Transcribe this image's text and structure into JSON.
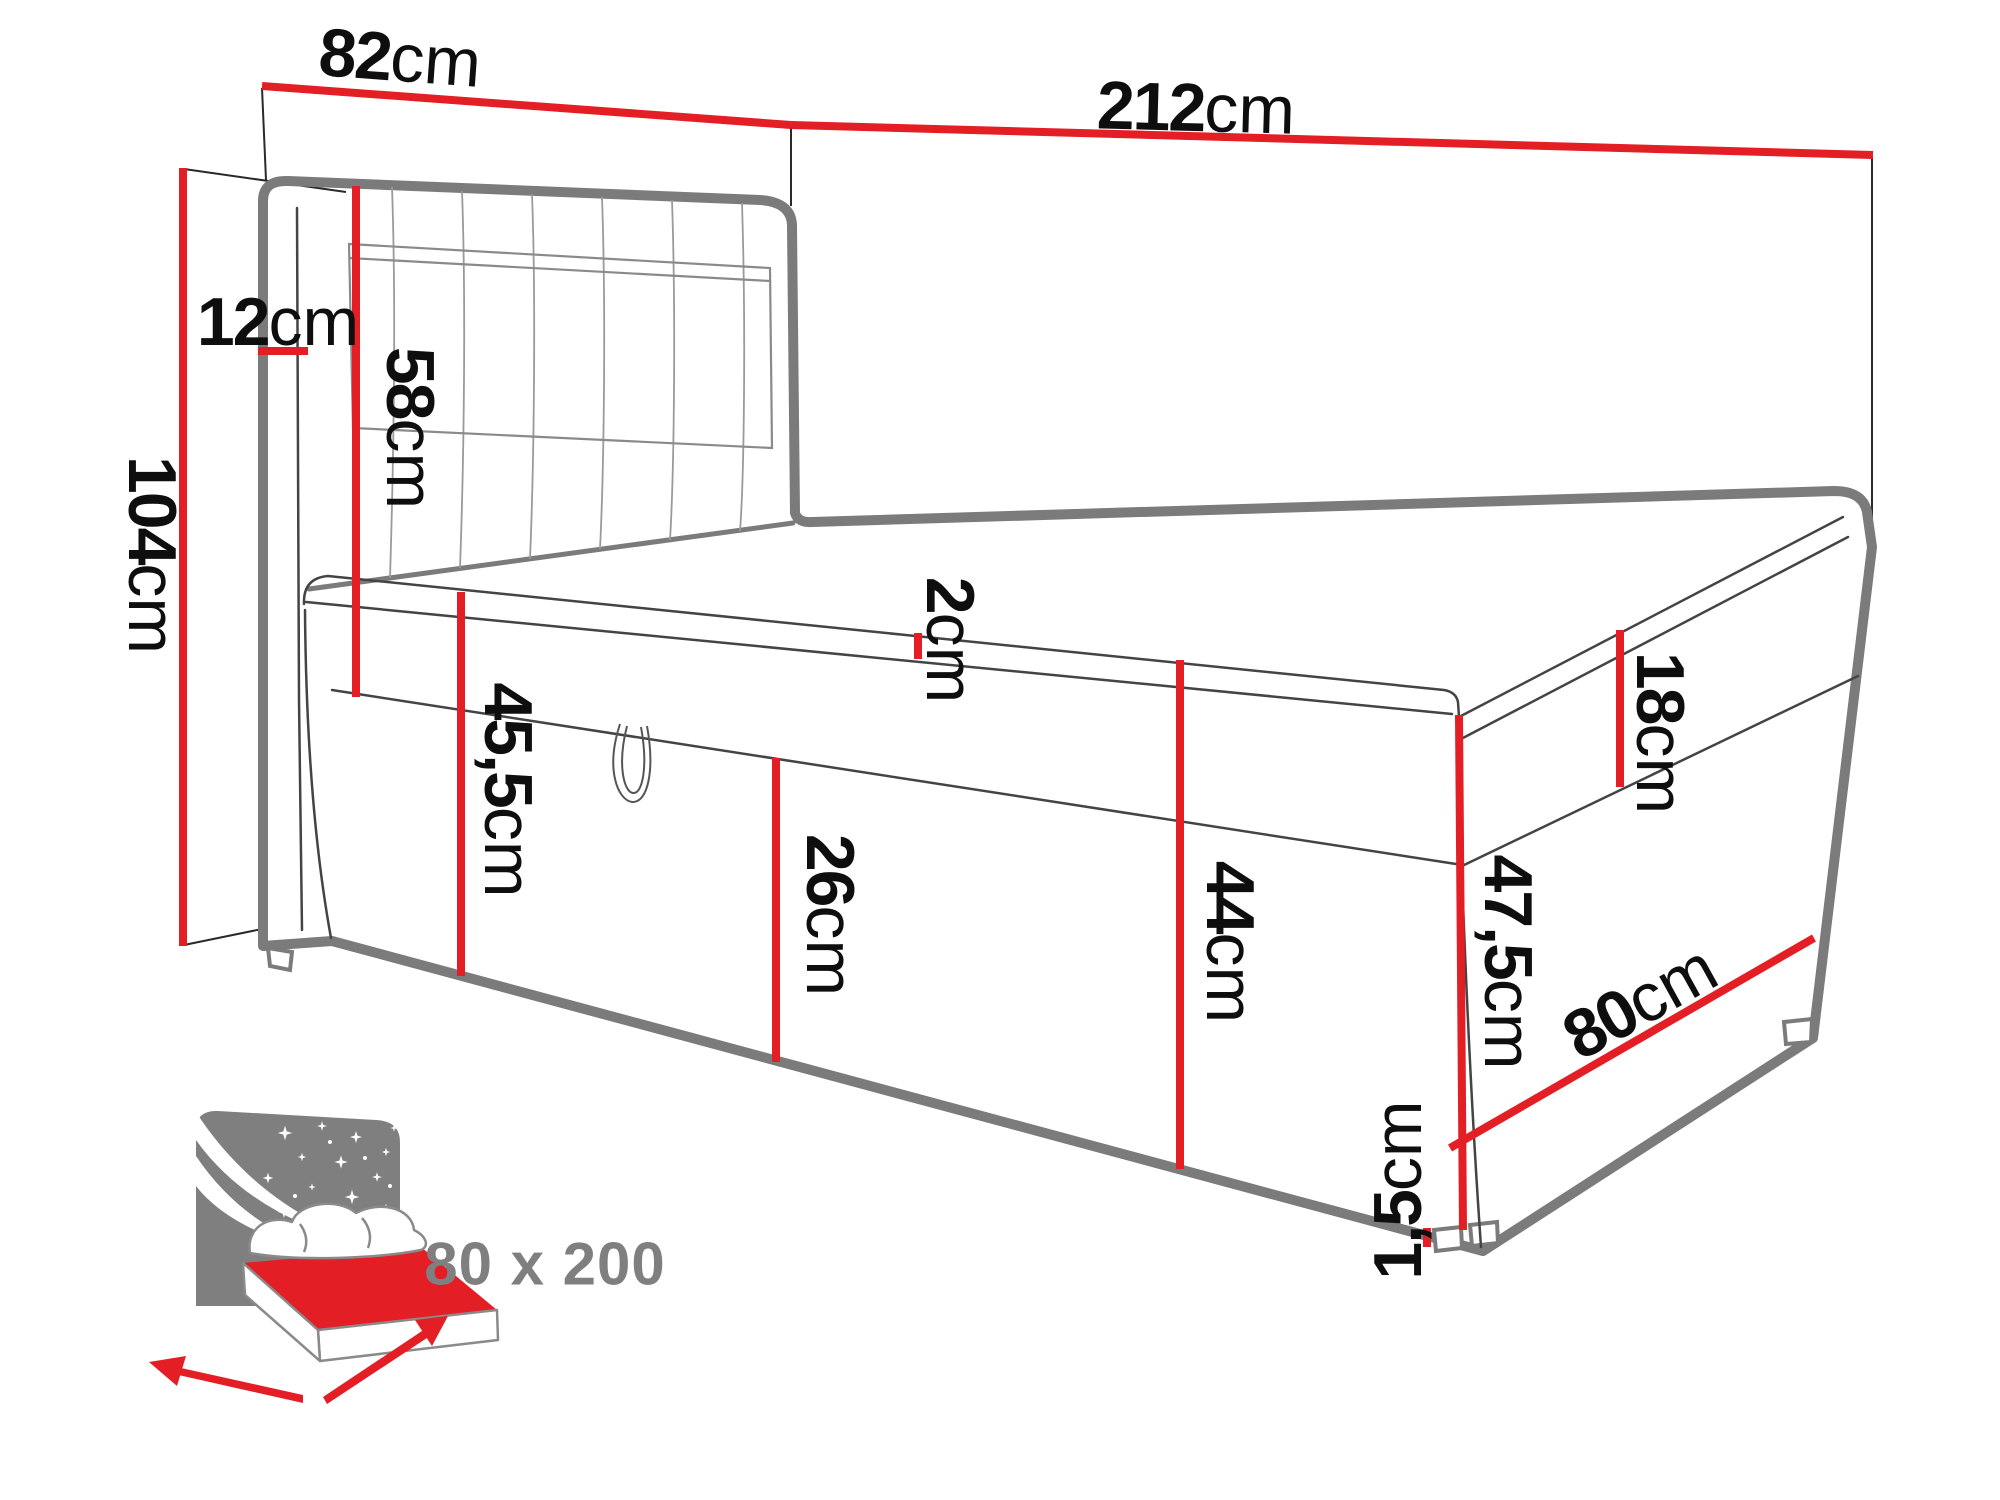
{
  "colors": {
    "dimension_red": "#e31e24",
    "drawing_gray": "#7b7b7b",
    "label_black": "#0e0e0e",
    "icon_gray": "#7f7f7f"
  },
  "dimensions": {
    "headboard_width": {
      "num": "82",
      "unit": "cm"
    },
    "total_length": {
      "num": "212",
      "unit": "cm"
    },
    "total_height": {
      "num": "104",
      "unit": "cm"
    },
    "headboard_depth": {
      "num": "12",
      "unit": "cm"
    },
    "headboard_height": {
      "num": "58",
      "unit": "cm"
    },
    "topper_height": {
      "num": "2",
      "unit": "cm"
    },
    "side_height": {
      "num": "45,5",
      "unit": "cm"
    },
    "drawer_height": {
      "num": "26",
      "unit": "cm"
    },
    "base_height": {
      "num": "44",
      "unit": "cm"
    },
    "mattress_height": {
      "num": "18",
      "unit": "cm"
    },
    "foot_height": {
      "num": "47,5",
      "unit": "cm"
    },
    "bed_width": {
      "num": "80",
      "unit": "cm"
    },
    "legs_height": {
      "num": "1,5",
      "unit": "cm"
    }
  },
  "icon": {
    "size_label": "80 x 200"
  }
}
